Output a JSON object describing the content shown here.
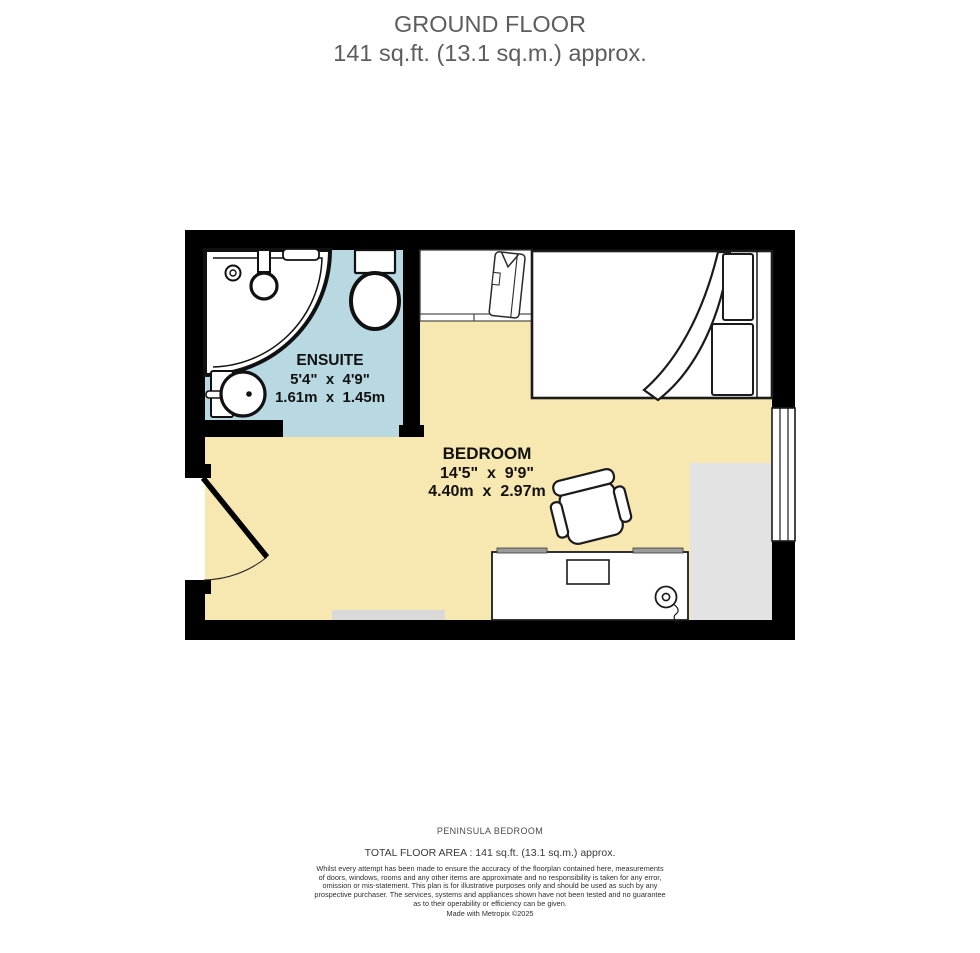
{
  "header": {
    "title": "GROUND FLOOR",
    "subtitle": "141 sq.ft. (13.1 sq.m.) approx."
  },
  "plan": {
    "ensuite": {
      "name": "ENSUITE",
      "dims_ft": "5'4\"  x  4'9\"",
      "dims_m": "1.61m  x  1.45m"
    },
    "bedroom": {
      "name": "BEDROOM",
      "dims_ft": "14'5\"  x  9'9\"",
      "dims_m": "4.40m  x  2.97m"
    }
  },
  "footer": {
    "property_name": "PENINSULA BEDROOM",
    "total_area": "TOTAL FLOOR AREA : 141 sq.ft. (13.1 sq.m.) approx.",
    "disclaimer_lines": [
      "Whilst every attempt has been made to ensure the accuracy of the floorplan contained here, measurements",
      "of doors, windows, rooms and any other items are approximate and no responsibility is taken for any error,",
      "omission or mis-statement. This plan is for illustrative purposes only and should be used as such by any",
      "prospective purchaser. The services, systems and appliances shown have not been tested and no guarantee",
      "as to their operability or efficiency can be given."
    ],
    "credit": "Made with Metropix ©2025"
  },
  "colors": {
    "wall": "#000000",
    "ensuite_floor": "#b8d9e2",
    "bedroom_floor": "#f7e7b0",
    "rug": "#e3e3e3",
    "mat": "#d9d9d9"
  }
}
